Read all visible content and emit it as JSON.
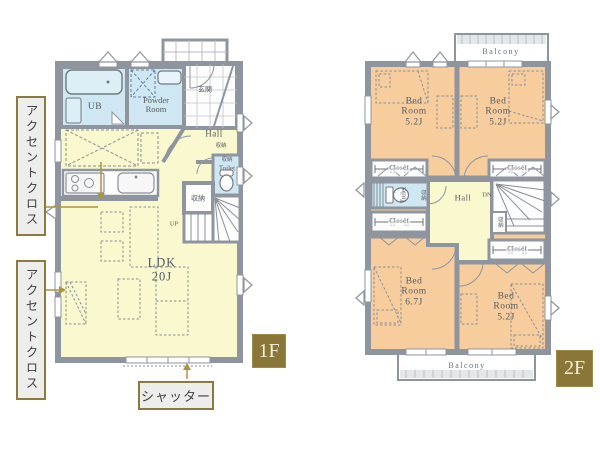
{
  "colors": {
    "wall": "#8f959e",
    "water_room": "#cfe7f2",
    "living_room": "#faf8cf",
    "bedroom": "#f7cd9e",
    "badge_olive": "#8a7637",
    "annotation_border": "#8b7a3e",
    "leader_line": "#ab9440"
  },
  "floor1": {
    "badge": "1F",
    "ub": "UB",
    "powder_room": "Powder|Room",
    "genkan": "玄関",
    "hall": "Hall",
    "hall_storage": "収納",
    "toilet": "Toilet",
    "toilet_storage": "収納",
    "storage": "収納",
    "up": "UP",
    "ldk": "LDK|20J"
  },
  "floor2": {
    "badge": "2F",
    "balcony_top": "Balcony",
    "balcony_bottom": "Balcony",
    "bedroom_top_left": "Bed|Room|5.2J",
    "bedroom_top_right": "Bed|Room|5.2J",
    "bedroom_bottom_left": "Bed|Room|6.7J",
    "bedroom_bottom_right": "Bed|Room|5.2J",
    "closet_top_left": "Closet",
    "closet_top_right": "Closet",
    "closet_mid_left": "Closet",
    "closet_bottom_right": "Closet",
    "toilet": "Toilet",
    "toilet_storage": "収納",
    "stair_storage": "収納",
    "hall": "Hall",
    "dn": "DN"
  },
  "annotations": {
    "accent_cloth_1": "アクセントクロス",
    "accent_cloth_2": "アクセントクロス",
    "shutter": "シャッター"
  }
}
